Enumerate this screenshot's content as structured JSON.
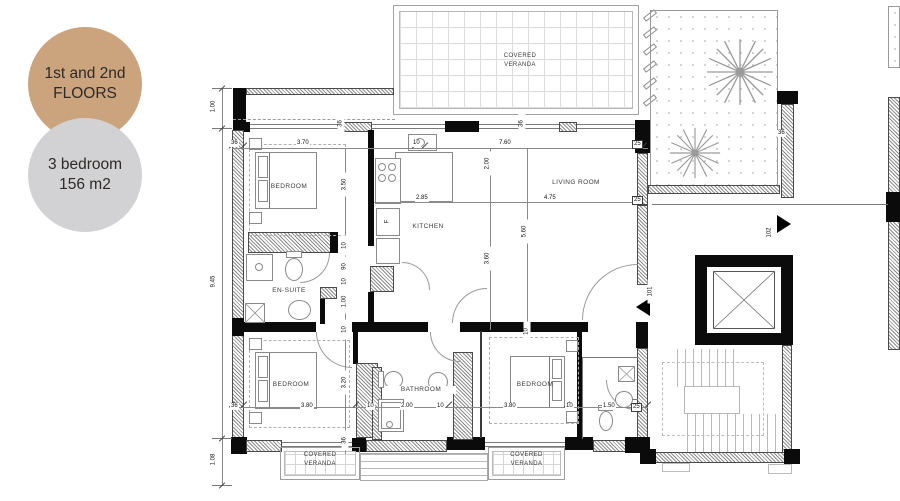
{
  "badges": {
    "floors_line1": "1st and 2nd",
    "floors_line2": "FLOORS",
    "unit_line1": "3 bedroom",
    "unit_line2": "156 m2"
  },
  "colors": {
    "badge_floors_bg": "#cba47e",
    "badge_unit_bg": "#d2d2d4",
    "badge_text": "#2e2a26",
    "wall": "#0b0b0b",
    "drawing_line": "#8a8a8a"
  },
  "rooms": {
    "bedroom": "BEDROOM",
    "kitchen": "KITCHEN",
    "living_room": "LIVING ROOM",
    "ensuite": "EN-SUITE",
    "bathroom": "BATHROOM",
    "covered": "COVERED",
    "veranda": "VERANDA",
    "fridge": "F"
  },
  "doors": {
    "entry": "101",
    "neighbor": "102"
  },
  "dims": {
    "d100": "1.00",
    "d945": "9.45",
    "d108": "1.08",
    "d36": "36",
    "d25": "25",
    "d10": "10",
    "d90": "90",
    "d370": "3.70",
    "d760": "7.60",
    "d285": "2.85",
    "d475": "4.75",
    "d200": "2.00",
    "d360": "3.60",
    "d560": "5.60",
    "d350": "3.50",
    "d320": "3.20",
    "d380": "3.80",
    "d150": "1.50"
  }
}
